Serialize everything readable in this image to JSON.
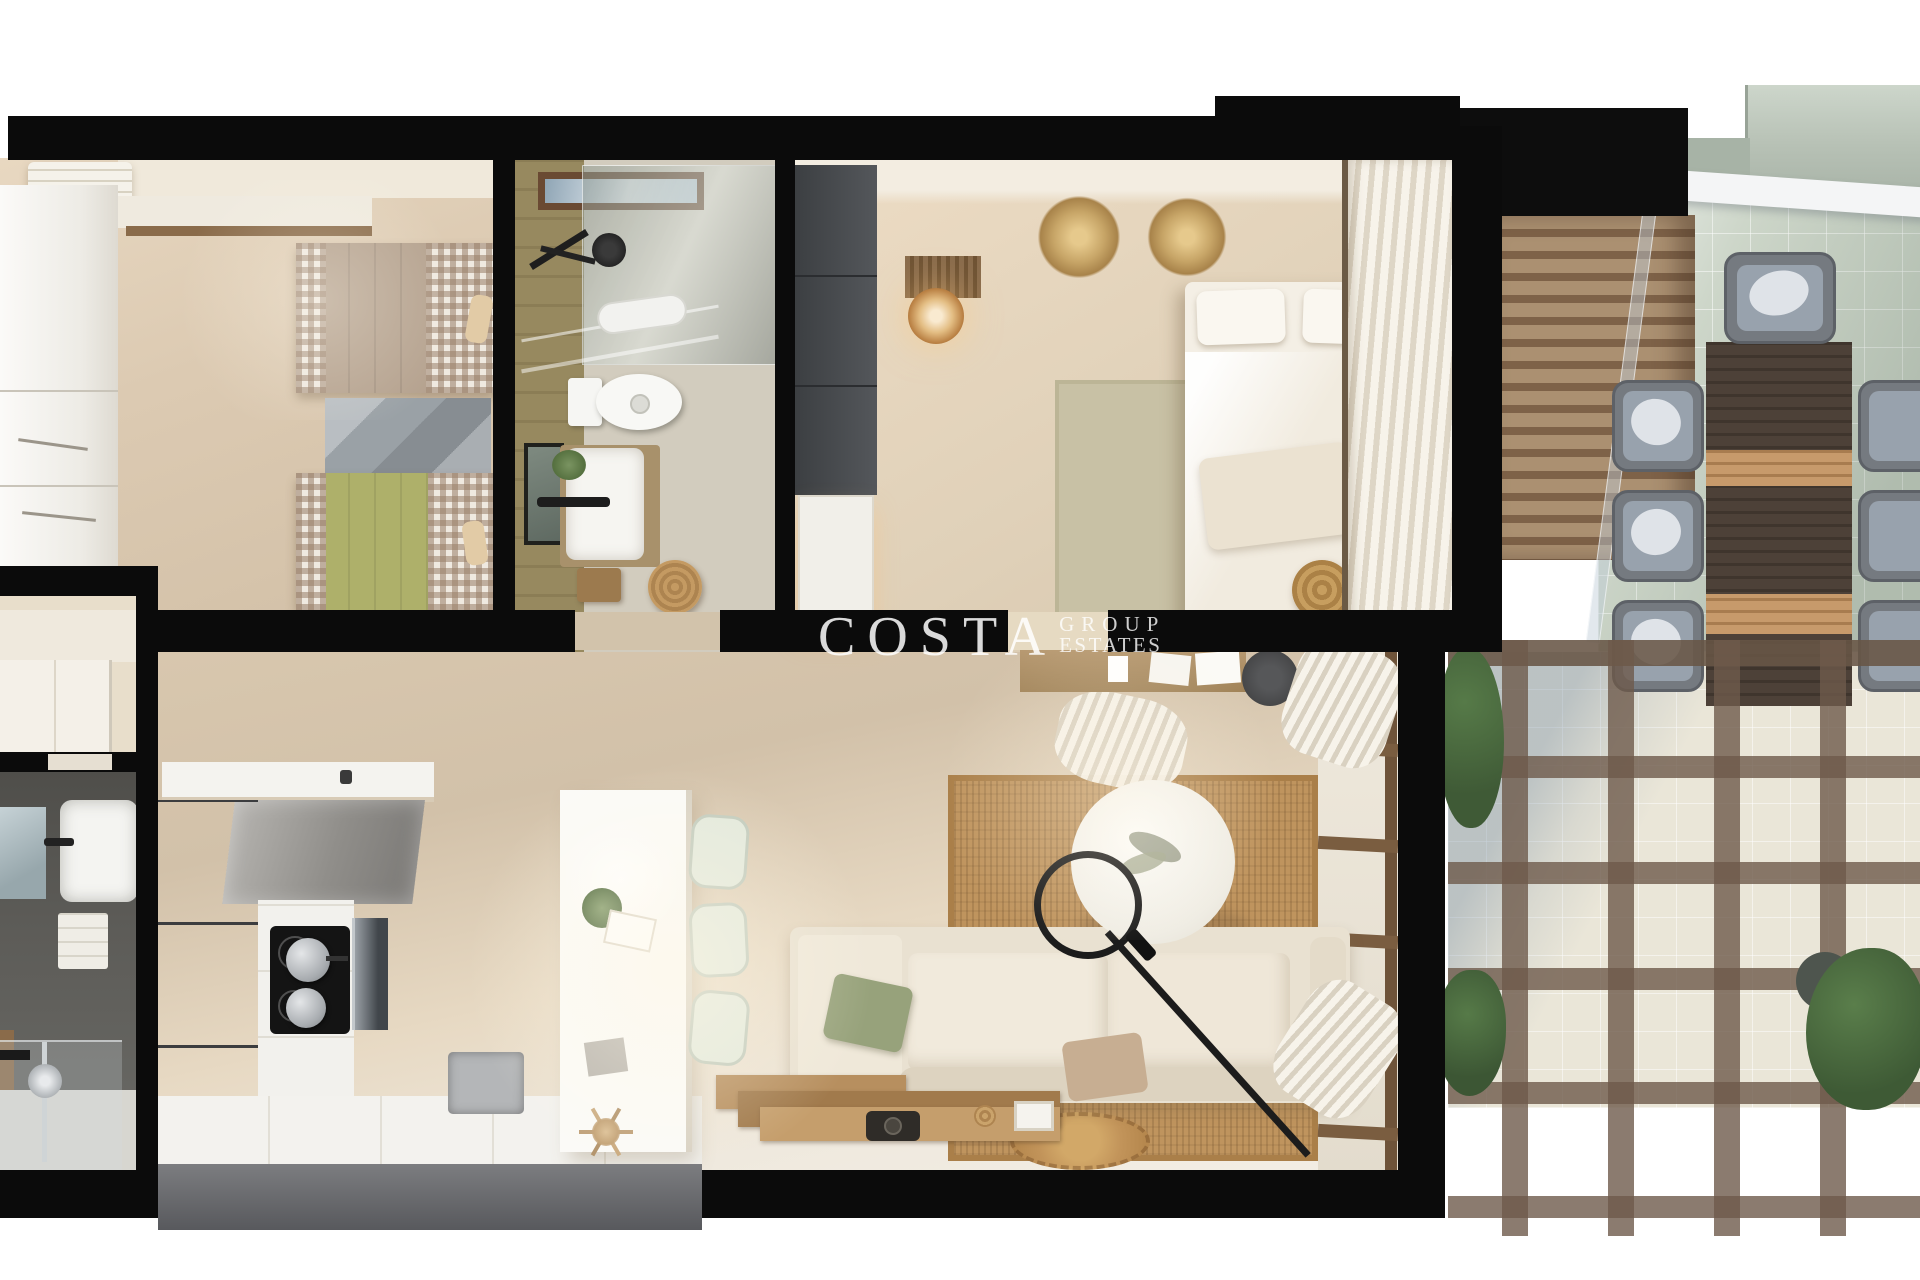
{
  "watermark": {
    "brand": "COSTA",
    "line1": "GROUP",
    "line2": "ESTATES"
  },
  "palette": {
    "background": "#ffffff",
    "walls_black": "#0b0b0b",
    "floor_warm_beige": "#d8c7ae",
    "floor_light_cream": "#efe9de",
    "kitchen_tall_units_gray": "#515254",
    "counter_white": "#f3f2ee",
    "island_white": "#fbfaf7",
    "stool_sage": "#e3e9dc",
    "sofa_cream": "#e9e1d1",
    "pillow_green": "#97a27b",
    "rug_jute_brown": "#c0955e",
    "rug_sage": "#c8c1a5",
    "twin_bed_taupe": "#b5a28f",
    "twin_bed_green": "#aeb06a",
    "bath_tile_olive": "#97895f",
    "bath2_tile_graphite": "#5a5955",
    "louver_wood": "#ab9071",
    "outdoor_table_wood": "#4d4138",
    "outdoor_chair_gray": "#98a2ad",
    "terrace_tile_green": "#cdd6c9",
    "pergola_beam": "rgba(110,90,75,0.8)",
    "medallion_gold": "#c7a567",
    "watermark_white": "rgba(255,255,255,0.85)"
  },
  "scene": {
    "type": "3d-floor-plan-top-view",
    "rooms": [
      {
        "name": "twin-bedroom",
        "items": [
          "white-wardrobe",
          "ac-unit",
          "wall-shelf",
          "single-bed-taupe",
          "single-bed-green",
          "gray-area-rug"
        ]
      },
      {
        "name": "bathroom-1",
        "items": [
          "skylight",
          "shower-glass",
          "shower-head",
          "toilet",
          "vanity-sink",
          "leaning-mirror",
          "rattan-basket",
          "wood-tray"
        ]
      },
      {
        "name": "master-bedroom",
        "items": [
          "graphite-wardrobe",
          "white-dresser",
          "slat-headboard-panel",
          "bedside-lamp",
          "double-bed",
          "sage-rug",
          "wall-medallion",
          "wall-medallion",
          "white-curtains",
          "rattan-pouf"
        ]
      },
      {
        "name": "hallway",
        "items": [
          "entry-door"
        ]
      },
      {
        "name": "bathroom-2",
        "items": [
          "mirror",
          "white-sink",
          "towel-shelf",
          "walk-in-shower",
          "shower-glass-panel"
        ]
      },
      {
        "name": "kitchen",
        "items": [
          "wall-counter",
          "faucet",
          "upper-cabinets",
          "tall-units",
          "cooktop",
          "cooking-pots",
          "oven",
          "base-counter",
          "base-sink",
          "island",
          "bar-stool",
          "bar-stool",
          "bar-stool",
          "island-plant",
          "dried-pampas"
        ]
      },
      {
        "name": "living-dining",
        "items": [
          "wall-desk",
          "desk-chair",
          "curtain-bundle",
          "jute-rug",
          "round-coffee-table",
          "arc-floor-lamp",
          "corner-sofa",
          "green-pillow",
          "tan-pillow",
          "white-pillow",
          "wood-sideboard",
          "camera-decor",
          "small-round-rug",
          "glazed-door-wall",
          "curtains"
        ]
      },
      {
        "name": "terrace",
        "items": [
          "louver-screen",
          "glass-balustrade",
          "white-awning",
          "neighbor-building",
          "outdoor-dining-table",
          "outdoor-chair-x7",
          "pergola-grid",
          "green-bush-x3",
          "round-planter"
        ]
      }
    ]
  }
}
